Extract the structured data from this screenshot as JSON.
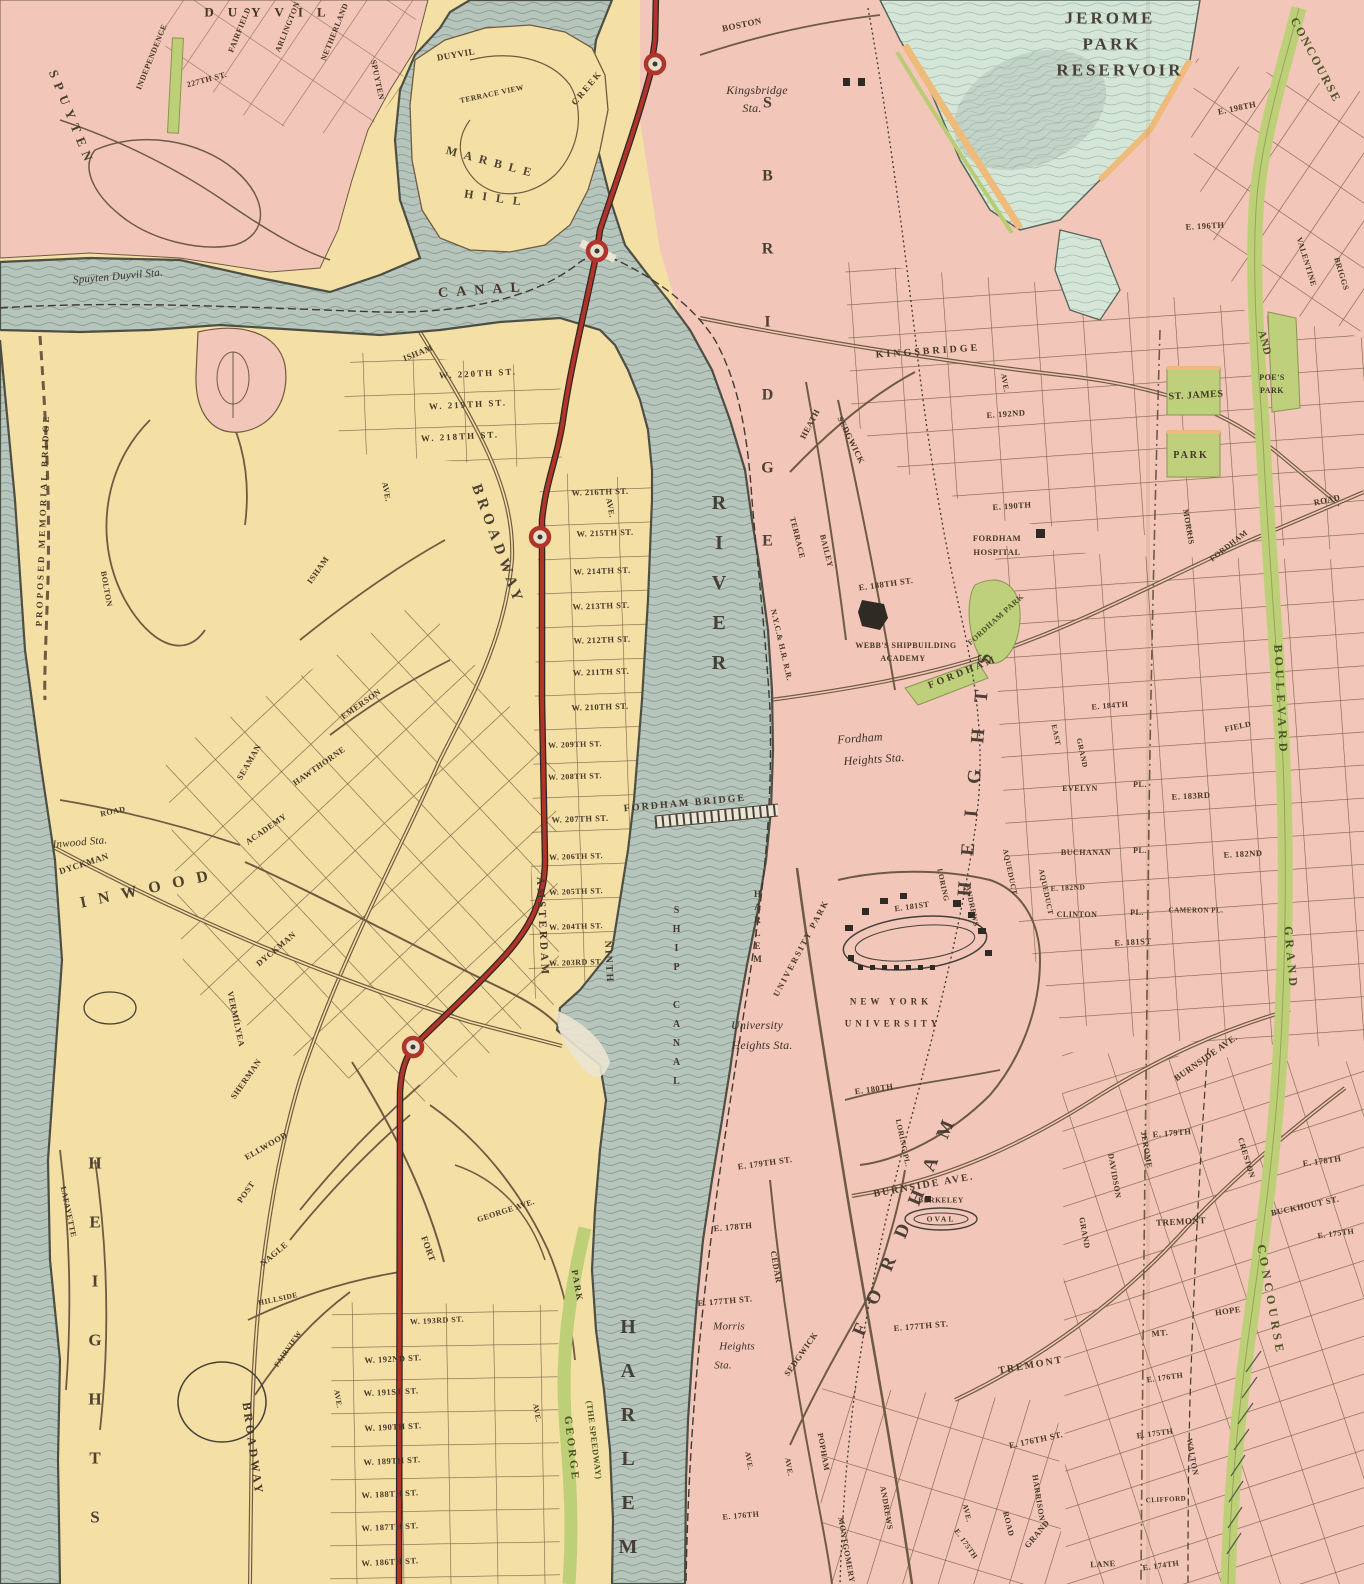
{
  "map": {
    "region": "Upper Manhattan and West Bronx",
    "water_features": [
      "Harlem River",
      "Ship Canal",
      "Spuyten Duyvil Creek",
      "Canal",
      "Jerome Park Reservoir"
    ],
    "transit": {
      "elevated_line_color": "#b0342a",
      "station_marker": "red circle"
    },
    "colors": {
      "land_manhattan": "#f4dfa4",
      "land_bronx": "#f2c6b8",
      "water": "#b7c5bc",
      "reservoir": "#d5e6d8",
      "park_green": "#bed07c",
      "road_green": "#bed077",
      "elevated_red": "#b0342a",
      "street_line": "#7b6349",
      "shore_line": "#4e4f44",
      "label_text": "#463729"
    }
  },
  "labels": [
    {
      "text": "DUYVIL"
    },
    {
      "text": "SPUYTEN"
    },
    {
      "text": "INDEPENDENCE"
    },
    {
      "text": "FAIRFIELD"
    },
    {
      "text": "ARLINGTON"
    },
    {
      "text": "NETHERLAND"
    },
    {
      "text": "SPUYTEN"
    },
    {
      "text": "227TH ST."
    },
    {
      "text": "Spuyten Duyvil Sta."
    },
    {
      "text": "DUYVIL"
    },
    {
      "text": "CREEK"
    },
    {
      "text": "TERRACE VIEW"
    },
    {
      "text": "MARBLE"
    },
    {
      "text": "HILL"
    },
    {
      "text": "CANAL"
    },
    {
      "text": "Kingsbridge"
    },
    {
      "text": "Sta."
    },
    {
      "text": "BOSTON"
    },
    {
      "text": "SBRIDGE"
    },
    {
      "text": "JEROME"
    },
    {
      "text": "PARK"
    },
    {
      "text": "RESERVOIR"
    },
    {
      "text": "CONCOURSE"
    },
    {
      "text": "E. 198TH"
    },
    {
      "text": "E. 196TH"
    },
    {
      "text": "VALENTINE"
    },
    {
      "text": "BRIGGS"
    },
    {
      "text": "KINGSBRIDGE"
    },
    {
      "text": "AVE."
    },
    {
      "text": "E. 192ND"
    },
    {
      "text": "ST. JAMES"
    },
    {
      "text": "PARK"
    },
    {
      "text": "POE'S"
    },
    {
      "text": "PARK"
    },
    {
      "text": "AND"
    },
    {
      "text": "E. 190TH"
    },
    {
      "text": "MORRIS"
    },
    {
      "text": "FORDHAM"
    },
    {
      "text": "ROAD"
    },
    {
      "text": "HEATH"
    },
    {
      "text": "SEDGWICK"
    },
    {
      "text": "TERRACE"
    },
    {
      "text": "BAILEY"
    },
    {
      "text": "N.Y.C.& H.R. R.R."
    },
    {
      "text": "FORDHAM"
    },
    {
      "text": "HOSPITAL"
    },
    {
      "text": "E. 188TH ST."
    },
    {
      "text": "WEBB'S SHIPBUILDING"
    },
    {
      "text": "ACADEMY"
    },
    {
      "text": "FORDHAM PARK"
    },
    {
      "text": "FORDHAM"
    },
    {
      "text": "Fordham"
    },
    {
      "text": "Heights Sta."
    },
    {
      "text": "FORDHAM BRIDGE"
    },
    {
      "text": "RIVER"
    },
    {
      "text": "HARLEM"
    },
    {
      "text": "SHIP CANAL"
    },
    {
      "text": "HARLEM"
    },
    {
      "text": "HEIGHTS"
    },
    {
      "text": "FORDHAM"
    },
    {
      "text": "University"
    },
    {
      "text": "Heights Sta."
    },
    {
      "text": "UNIVERSITY PARK"
    },
    {
      "text": "NEW YORK"
    },
    {
      "text": "UNIVERSITY"
    },
    {
      "text": "E. 181ST"
    },
    {
      "text": "LORING"
    },
    {
      "text": "ANDREWS"
    },
    {
      "text": "AQUEDUCT"
    },
    {
      "text": "AQUEDUCT"
    },
    {
      "text": "EAST"
    },
    {
      "text": "GRAND"
    },
    {
      "text": "EVELYN"
    },
    {
      "text": "PL."
    },
    {
      "text": "E. 183RD"
    },
    {
      "text": "BUCHANAN"
    },
    {
      "text": "PL."
    },
    {
      "text": "E. 182ND"
    },
    {
      "text": "E. 182ND"
    },
    {
      "text": "CLINTON"
    },
    {
      "text": "PL."
    },
    {
      "text": "CAMERON PL."
    },
    {
      "text": "E. 181ST"
    },
    {
      "text": "FIELD"
    },
    {
      "text": "E. 184TH"
    },
    {
      "text": "E. 180TH"
    },
    {
      "text": "LORING PL."
    },
    {
      "text": "BURNSIDE AVE."
    },
    {
      "text": "BERKELEY"
    },
    {
      "text": "OVAL"
    },
    {
      "text": "BURNSIDE AVE."
    },
    {
      "text": "E. 179TH"
    },
    {
      "text": "E. 178TH"
    },
    {
      "text": "BUCKHOUT ST."
    },
    {
      "text": "CRESTON"
    },
    {
      "text": "JEROME"
    },
    {
      "text": "DAVIDSON"
    },
    {
      "text": "GRAND"
    },
    {
      "text": "E. 179TH ST."
    },
    {
      "text": "E. 178TH"
    },
    {
      "text": "E. 177TH ST."
    },
    {
      "text": "Morris"
    },
    {
      "text": "Heights"
    },
    {
      "text": "Sta."
    },
    {
      "text": "CEDAR"
    },
    {
      "text": "SEDGWICK"
    },
    {
      "text": "E. 177TH ST."
    },
    {
      "text": "TREMONT"
    },
    {
      "text": "TREMONT"
    },
    {
      "text": "MT."
    },
    {
      "text": "HOPE"
    },
    {
      "text": "E. 176TH ST."
    },
    {
      "text": "E. 176TH"
    },
    {
      "text": "E. 175TH"
    },
    {
      "text": "E. 175TH"
    },
    {
      "text": "HARRISON"
    },
    {
      "text": "GRAND"
    },
    {
      "text": "ROAD"
    },
    {
      "text": "AVE."
    },
    {
      "text": "E. 175TH"
    },
    {
      "text": "LANE"
    },
    {
      "text": "E. 174TH"
    },
    {
      "text": "CLIFFORD"
    },
    {
      "text": "WALTON"
    },
    {
      "text": "POPHAM"
    },
    {
      "text": "ANDREWS"
    },
    {
      "text": "MONTGOMERY"
    },
    {
      "text": "AVE."
    },
    {
      "text": "AVE."
    },
    {
      "text": "E. 176TH"
    },
    {
      "text": "BOULEVARD"
    },
    {
      "text": "GRAND"
    },
    {
      "text": "CONCOURSE"
    },
    {
      "text": "PROPOSED MEMORIAL BRIDGE"
    },
    {
      "text": "BOLTON"
    },
    {
      "text": "ROAD"
    },
    {
      "text": "Inwood Sta."
    },
    {
      "text": "DYCKMAN"
    },
    {
      "text": "INWOOD"
    },
    {
      "text": "ISHAM"
    },
    {
      "text": "ISHAM"
    },
    {
      "text": "EMERSON"
    },
    {
      "text": "SEAMAN"
    },
    {
      "text": "HAWTHORNE"
    },
    {
      "text": "ACADEMY"
    },
    {
      "text": "DYCKMAN"
    },
    {
      "text": "VERMILYEA"
    },
    {
      "text": "SHERMAN"
    },
    {
      "text": "ELLWOOD"
    },
    {
      "text": "POST"
    },
    {
      "text": "NAGLE"
    },
    {
      "text": "HILLSIDE"
    },
    {
      "text": "FAIRVIEW"
    },
    {
      "text": "LAFAYETTE"
    },
    {
      "text": "BROADWAY"
    },
    {
      "text": "BROADWAY"
    },
    {
      "text": "AMSTERDAM"
    },
    {
      "text": "NINTH"
    },
    {
      "text": "AVE."
    },
    {
      "text": "AVE."
    },
    {
      "text": "W. 220TH ST."
    },
    {
      "text": "W. 219TH ST."
    },
    {
      "text": "W. 218TH ST."
    },
    {
      "text": "W. 216TH ST."
    },
    {
      "text": "W. 215TH ST."
    },
    {
      "text": "W. 214TH ST."
    },
    {
      "text": "W. 213TH ST."
    },
    {
      "text": "W. 212TH ST."
    },
    {
      "text": "W. 211TH ST."
    },
    {
      "text": "W. 210TH ST."
    },
    {
      "text": "W. 209TH ST."
    },
    {
      "text": "W. 208TH ST."
    },
    {
      "text": "W. 207TH ST."
    },
    {
      "text": "W. 206TH ST."
    },
    {
      "text": "W. 205TH ST."
    },
    {
      "text": "W. 204TH ST."
    },
    {
      "text": "W. 203RD ST."
    },
    {
      "text": "W. 193RD ST."
    },
    {
      "text": "W. 192ND ST."
    },
    {
      "text": "W. 191ST ST."
    },
    {
      "text": "W. 190TH ST."
    },
    {
      "text": "W. 189TH ST."
    },
    {
      "text": "W. 188TH ST."
    },
    {
      "text": "W. 187TH ST."
    },
    {
      "text": "W. 186TH ST."
    },
    {
      "text": "AVE."
    },
    {
      "text": "AVE."
    },
    {
      "text": "FORT"
    },
    {
      "text": "GEORGE AVE."
    },
    {
      "text": "PARK"
    },
    {
      "text": "GEORGE"
    },
    {
      "text": "(THE SPEEDWAY)"
    },
    {
      "text": "HEIGHTS"
    }
  ]
}
